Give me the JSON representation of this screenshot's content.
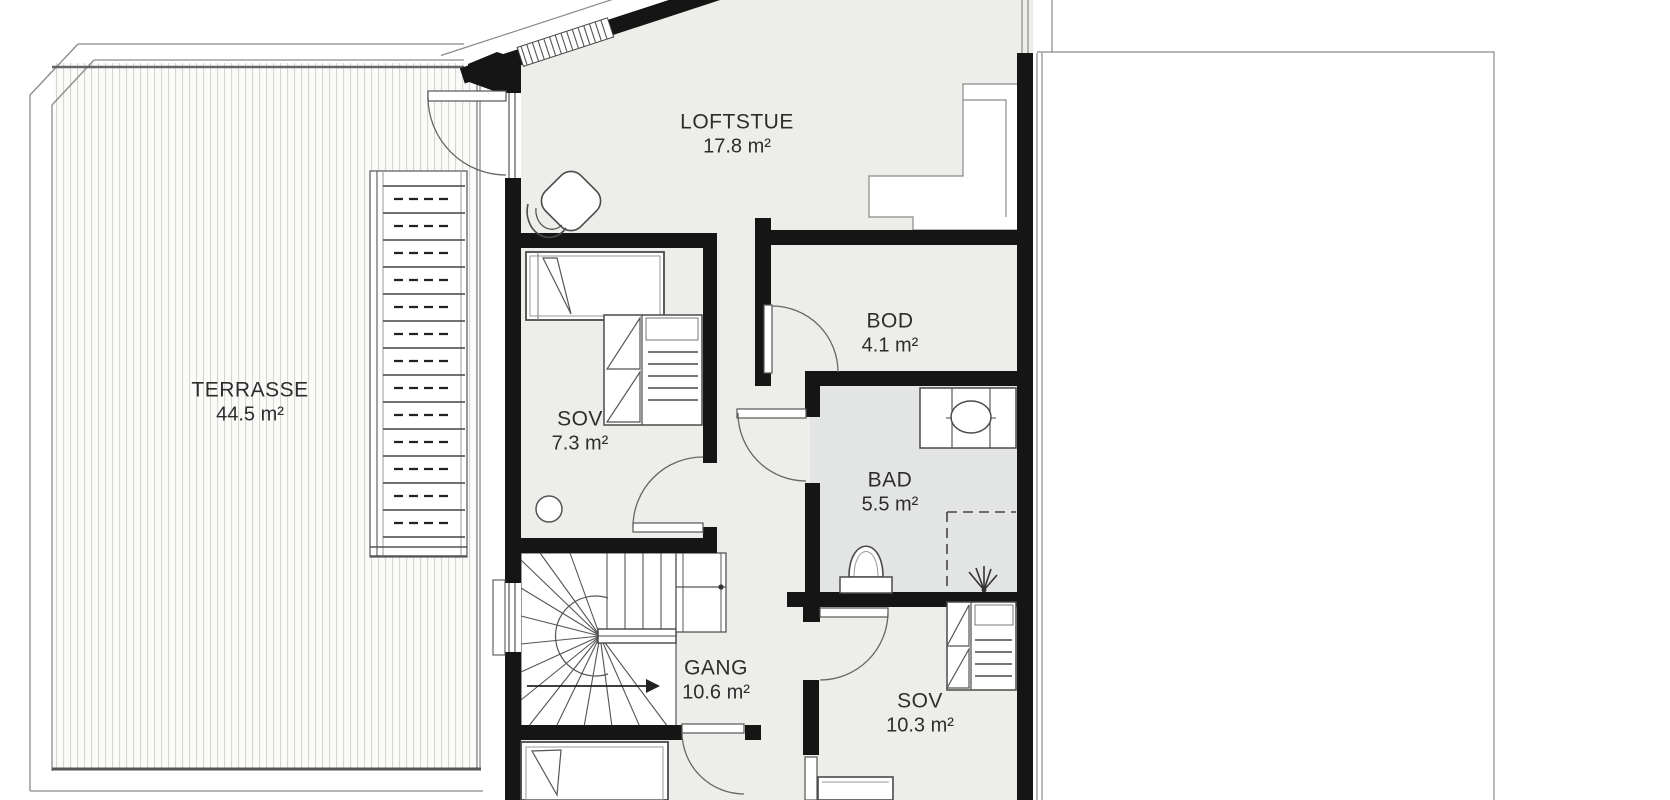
{
  "plan": {
    "kind": "floor-plan",
    "rooms": [
      {
        "id": "loftstue",
        "name": "LOFTSTUE",
        "area": "17.8 m²"
      },
      {
        "id": "bod",
        "name": "BOD",
        "area": "4.1 m²"
      },
      {
        "id": "sov1",
        "name": "SOV",
        "area": "7.3 m²"
      },
      {
        "id": "bad",
        "name": "BAD",
        "area": "5.5 m²"
      },
      {
        "id": "gang",
        "name": "GANG",
        "area": "10.6 m²"
      },
      {
        "id": "sov2",
        "name": "SOV",
        "area": "10.3 m²"
      },
      {
        "id": "terrasse",
        "name": "TERRASSE",
        "area": "44.5 m²"
      }
    ],
    "icons": [
      "bed-icon",
      "wardrobe-icon",
      "toilet-icon",
      "vanity-sink-icon",
      "shower-icon",
      "armchair-icon",
      "stool-icon",
      "winder-stair-icon",
      "terrace-stair-icon",
      "door-swing-icon",
      "direction-arrow-icon"
    ]
  },
  "colors": {
    "wall": "#151515",
    "floor": "#edeeea",
    "bad-floor": "#e2e5e4",
    "line": "#4d4d4d",
    "thin": "#777777",
    "deck-line": "#d5d5d2",
    "text": "#2d2d2d"
  }
}
